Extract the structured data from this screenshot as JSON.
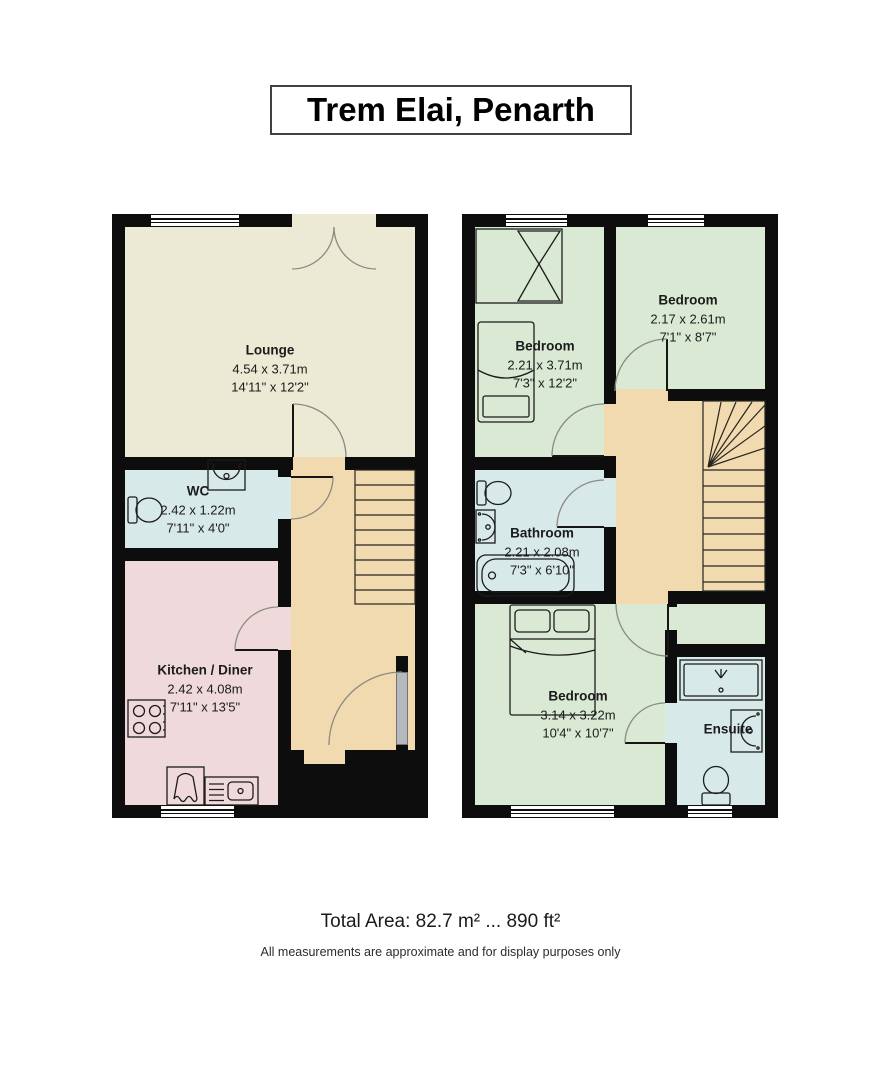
{
  "title": "Trem Elai, Penarth",
  "ground_floor": {
    "lounge": {
      "name": "Lounge",
      "dim_m": "4.54 x 3.71m",
      "dim_ft": "14'11\" x 12'2\""
    },
    "wc": {
      "name": "WC",
      "dim_m": "2.42 x 1.22m",
      "dim_ft": "7'11\" x 4'0\""
    },
    "kitchen": {
      "name": "Kitchen / Diner",
      "dim_m": "2.42 x 4.08m",
      "dim_ft": "7'11\" x 13'5\""
    }
  },
  "first_floor": {
    "bedroom_front": {
      "name": "Bedroom",
      "dim_m": "2.21 x 3.71m",
      "dim_ft": "7'3\" x 12'2\""
    },
    "bedroom_right": {
      "name": "Bedroom",
      "dim_m": "2.17 x 2.61m",
      "dim_ft": "7'1\" x 8'7\""
    },
    "bathroom": {
      "name": "Bathroom",
      "dim_m": "2.21 x 2.08m",
      "dim_ft": "7'3\" x 6'10\""
    },
    "bedroom_back": {
      "name": "Bedroom",
      "dim_m": "3.14 x 3.22m",
      "dim_ft": "10'4\" x 10'7\""
    },
    "ensuite": {
      "name": "Ensuite"
    }
  },
  "footer": {
    "total_area": "Total Area: 82.7 m² ... 890 ft²",
    "disclaimer": "All measurements are approximate and for display purposes only"
  },
  "colors": {
    "wall": "#0d0d0d",
    "lounge": "#ecead4",
    "bathroom_blue": "#d8e9e9",
    "kitchen_pink": "#efd9db",
    "hall_tan": "#f1d9b0",
    "bedroom_green": "#d9e9d4",
    "door_gray": "#b5b8bc",
    "swing_arc": "#8b8b80",
    "text": "#1b1b1b"
  }
}
